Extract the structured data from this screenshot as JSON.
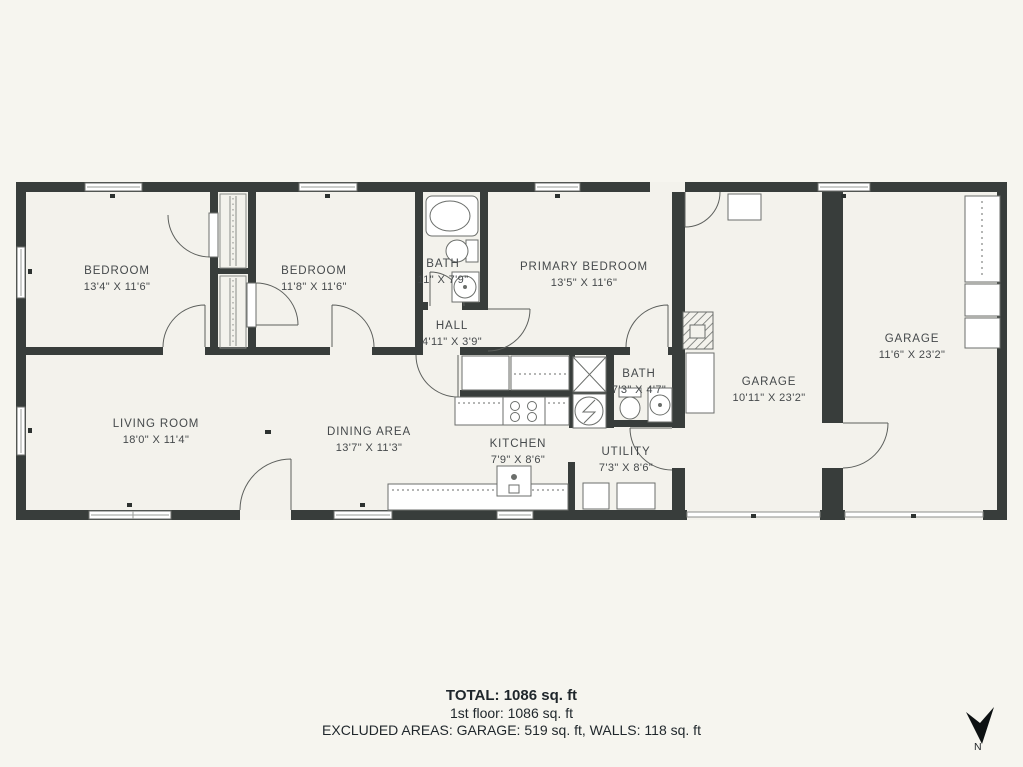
{
  "plan": {
    "rooms": [
      {
        "name": "BEDROOM",
        "dims": "13'4\" X 11'6\""
      },
      {
        "name": "BEDROOM",
        "dims": "11'8\" X 11'6\""
      },
      {
        "name": "BATH",
        "dims": "11\" X 7'9\""
      },
      {
        "name": "PRIMARY BEDROOM",
        "dims": "13'5\" X 11'6\""
      },
      {
        "name": "HALL",
        "dims": "4'11\" X 3'9\""
      },
      {
        "name": "LIVING ROOM",
        "dims": "18'0\" X 11'4\""
      },
      {
        "name": "DINING AREA",
        "dims": "13'7\" X 11'3\""
      },
      {
        "name": "KITCHEN",
        "dims": "7'9\" X 8'6\""
      },
      {
        "name": "BATH",
        "dims": "7'3\" X 4'7\""
      },
      {
        "name": "UTILITY",
        "dims": "7'3\" X 8'6\""
      },
      {
        "name": "GARAGE",
        "dims": "10'11\" X 23'2\""
      },
      {
        "name": "GARAGE",
        "dims": "11'6\" X 23'2\""
      }
    ],
    "compass": {
      "label": "N"
    }
  },
  "footer": {
    "total": "TOTAL: 1086 sq. ft",
    "floor": "1st floor: 1086 sq. ft",
    "excluded": "EXCLUDED AREAS: GARAGE: 519 sq. ft, WALLS: 118 sq. ft"
  },
  "colors": {
    "wall": "#383d3b",
    "background": "#f6f5ef",
    "floor": "#f3f2ec"
  }
}
